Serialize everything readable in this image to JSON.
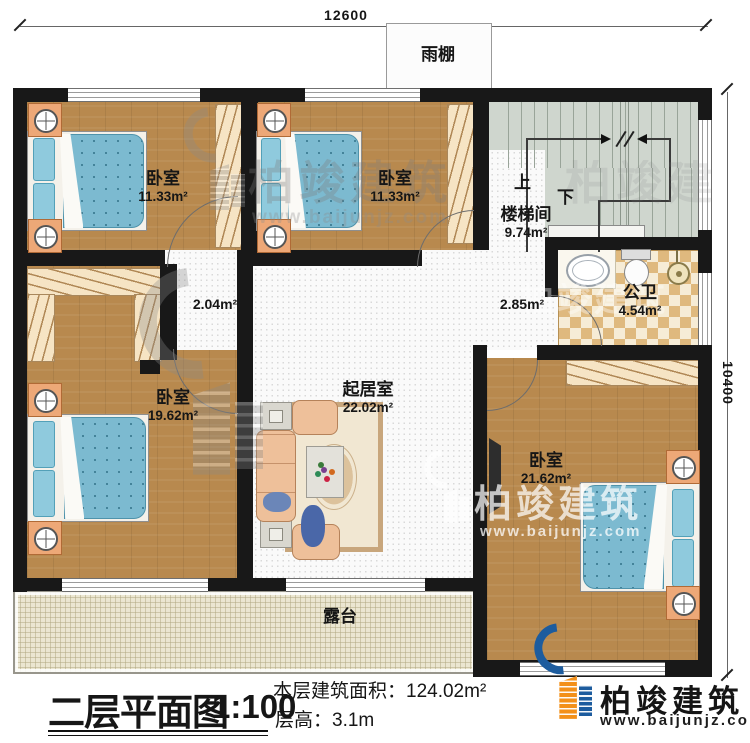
{
  "meta": {
    "plan_title": "二层平面图",
    "plan_scale": "1:100",
    "area_note": "本层建筑面积：124.02m²",
    "floor_height_note": "层高：3.1m"
  },
  "dimensions": {
    "top": "12600",
    "right": "10400"
  },
  "canopy_label": "雨棚",
  "rooms": {
    "bedroom_top_left": {
      "name": "卧室",
      "area": "11.33m²"
    },
    "bedroom_top_mid": {
      "name": "卧室",
      "area": "11.33m²"
    },
    "stairwell": {
      "name": "楼梯间",
      "area": "9.74m²",
      "up": "上",
      "down": "下"
    },
    "bathroom": {
      "name": "公卫",
      "area": "4.54m²"
    },
    "hall_west": {
      "area": "2.04m²"
    },
    "hall_east": {
      "area": "2.85m²"
    },
    "bedroom_left": {
      "name": "卧室",
      "area": "19.62m²"
    },
    "living_room": {
      "name": "起居室",
      "area": "22.02m²"
    },
    "bedroom_right": {
      "name": "卧室",
      "area": "21.62m²"
    },
    "terrace": {
      "name": "露台"
    }
  },
  "brand": {
    "name": "柏竣建筑",
    "url": "www.baijunjz.com"
  },
  "watermark": {
    "text": "柏竣建筑",
    "url": "www.baijunjz.com"
  },
  "colors": {
    "wall": "#181818",
    "wood_floor": "#b8894e",
    "stair_floor": "#cfd6ce",
    "bath_tile": "#dfb97e",
    "terrace_floor": "#ebe6d1",
    "bed_blue": "#7cbad0",
    "sofa_peach": "#eec09a",
    "brand_blue": "#1d5c9e",
    "brand_orange": "#f39019"
  }
}
